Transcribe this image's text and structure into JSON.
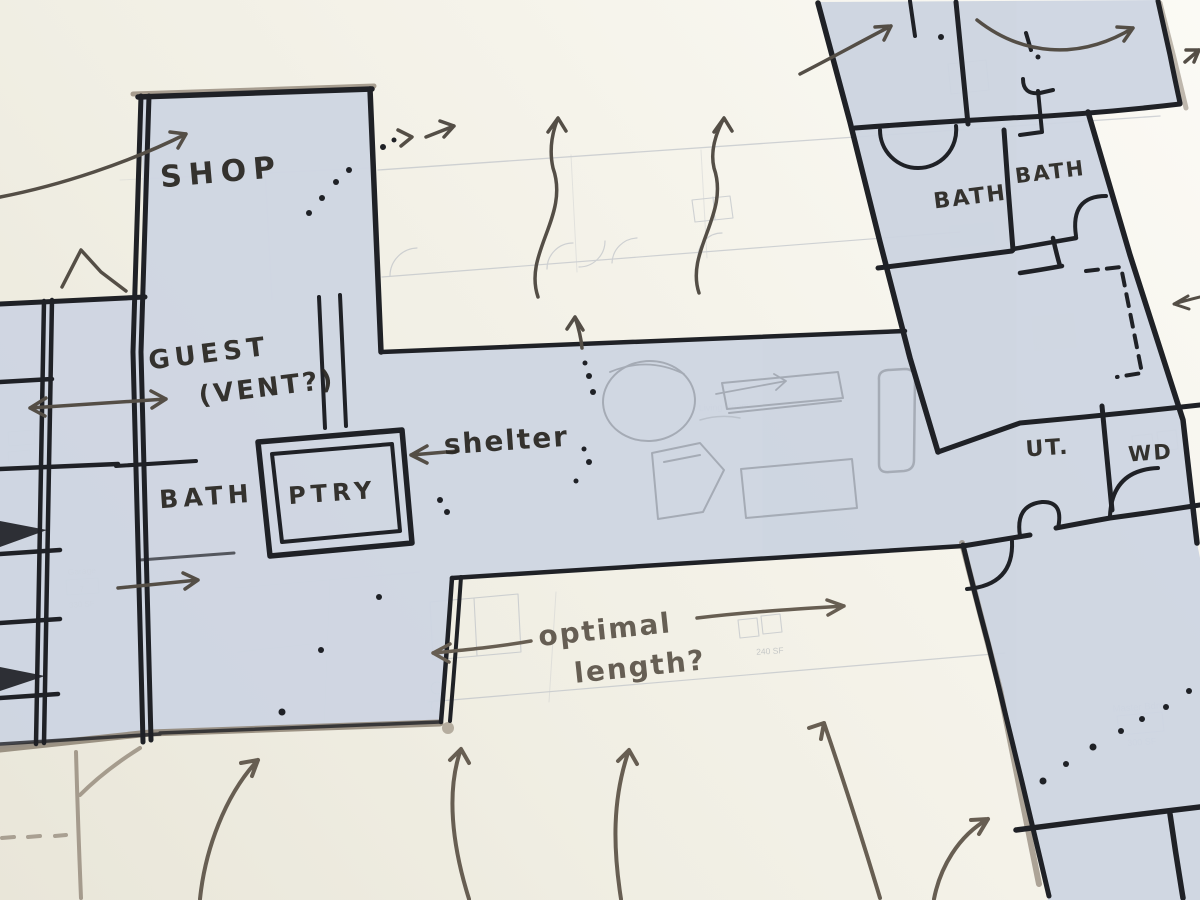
{
  "colors": {
    "paper_dark": "#e9e6d9",
    "paper_mid": "#f2f0e6",
    "paper_light": "#fbfaf5",
    "plan_shade": "#cdd5e1",
    "ink": "#1f2126",
    "marker_tan": "#8d8273",
    "arrow_gray": "#544e46",
    "arrow_brown": "#675e52",
    "pencil_gray": "#9ba1ab",
    "print_line": "#b7bcc4",
    "print_text": "#99a0a8",
    "handwriting_ink": "#2b2823",
    "handwriting_brown": "#5e564b"
  },
  "handwritten_labels": [
    {
      "id": "shop",
      "text": "SHOP",
      "x": 222,
      "y": 182,
      "rot": -5,
      "size": 30,
      "ls": 7
    },
    {
      "id": "guest",
      "text": "GUEST",
      "x": 210,
      "y": 362,
      "rot": -7,
      "size": 26,
      "ls": 5
    },
    {
      "id": "vent",
      "text": "(VENT?)",
      "x": 268,
      "y": 396,
      "rot": -7,
      "size": 26,
      "ls": 3
    },
    {
      "id": "bath-left",
      "text": "BATH",
      "x": 207,
      "y": 505,
      "rot": -4,
      "size": 25,
      "ls": 5
    },
    {
      "id": "ptry",
      "text": "PTRY",
      "x": 333,
      "y": 501,
      "rot": -4,
      "size": 24,
      "ls": 5
    },
    {
      "id": "shelter",
      "text": "shelter",
      "x": 507,
      "y": 450,
      "rot": -4,
      "size": 28,
      "ls": 2
    },
    {
      "id": "optimal",
      "text": "optimal",
      "x": 606,
      "y": 639,
      "rot": -6,
      "size": 28,
      "ls": 2,
      "color": "#5e564b"
    },
    {
      "id": "length",
      "text": "length?",
      "x": 641,
      "y": 676,
      "rot": -6,
      "size": 28,
      "ls": 2,
      "color": "#5e564b"
    },
    {
      "id": "bath-right-1",
      "text": "BATH",
      "x": 971,
      "y": 204,
      "rot": -7,
      "size": 22,
      "ls": 2
    },
    {
      "id": "bath-right-2",
      "text": "BATH",
      "x": 1051,
      "y": 179,
      "rot": -7,
      "size": 21,
      "ls": 2
    },
    {
      "id": "ut",
      "text": "UT.",
      "x": 1048,
      "y": 455,
      "rot": -4,
      "size": 22,
      "ls": 2
    },
    {
      "id": "wd",
      "text": "WD",
      "x": 1151,
      "y": 460,
      "rot": -4,
      "size": 21,
      "ls": 2
    }
  ],
  "printed_labels": [
    {
      "id": "garage",
      "text": "Garage",
      "x": 82,
      "y": 574,
      "rot": -4,
      "size": 8.5
    },
    {
      "id": "garage-num",
      "text": "7",
      "x": 82,
      "y": 592,
      "rot": -4,
      "size": 8
    },
    {
      "id": "garage-sf",
      "text": "330 SF",
      "x": 82,
      "y": 607,
      "rot": -4,
      "size": 8
    },
    {
      "id": "living",
      "text": "Living Room",
      "x": 724,
      "y": 410,
      "rot": -3,
      "size": 9
    },
    {
      "id": "dining-sf",
      "text": "240 SF",
      "x": 770,
      "y": 654,
      "rot": -3,
      "size": 8.5
    },
    {
      "id": "master",
      "text": "Master Bdrm",
      "x": 1140,
      "y": 710,
      "rot": -4,
      "size": 9.5
    },
    {
      "id": "master-sf",
      "text": "300 SF",
      "x": 1142,
      "y": 745,
      "rot": -4,
      "size": 9
    }
  ]
}
